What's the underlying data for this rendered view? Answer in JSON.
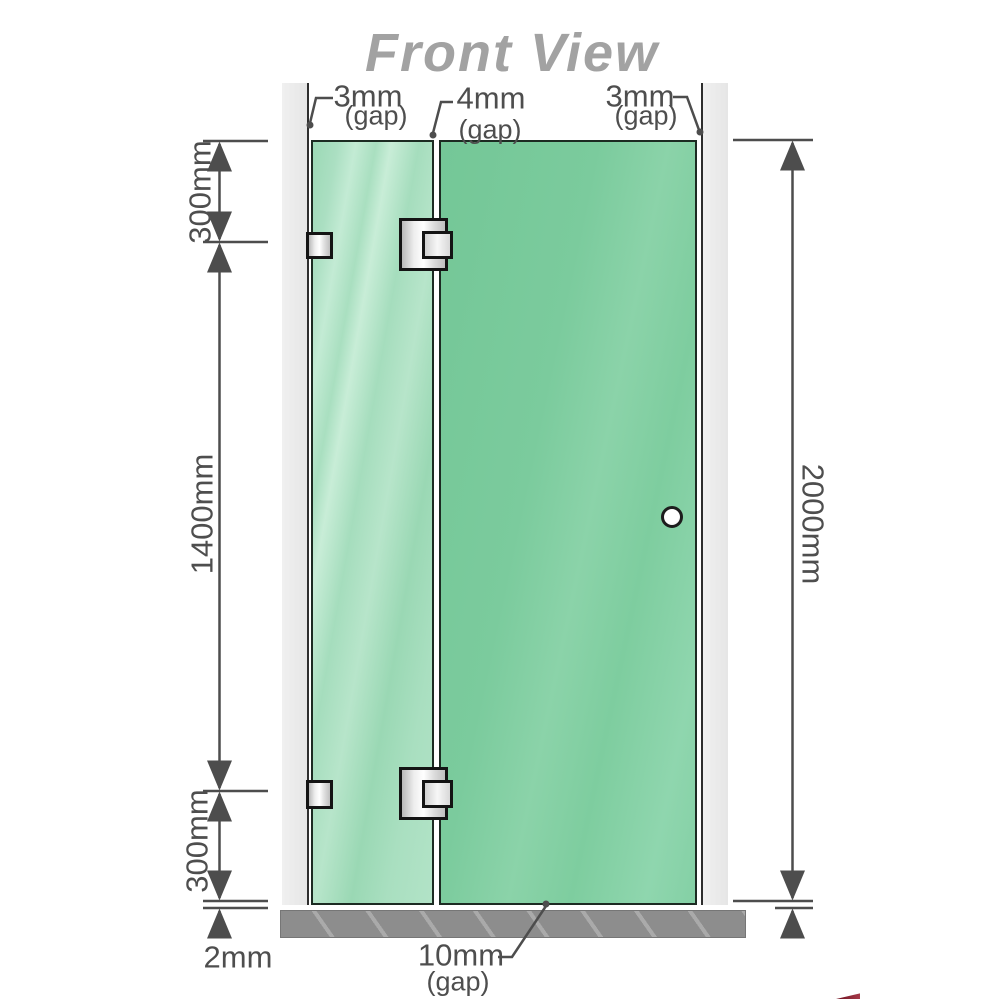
{
  "title": "Front View",
  "annotations": {
    "gap_top_left": {
      "value": "3mm",
      "note": "(gap)"
    },
    "gap_top_middle": {
      "value": "4mm",
      "note": "(gap)"
    },
    "gap_top_right": {
      "value": "3mm",
      "note": "(gap)"
    },
    "gap_bottom": {
      "value": "10mm",
      "note": "(gap)"
    },
    "floor_clearance": {
      "value": "2mm"
    }
  },
  "dimensions": {
    "left_top": "300mm",
    "left_middle": "1400mm",
    "left_bottom": "300mm",
    "right_total": "2000mm"
  },
  "colors": {
    "glass_fixed_panel": "#a9dfc0",
    "glass_door_panel": "#7ecd9f",
    "glass_outline": "#1c2b22",
    "wall": "#ebebeb",
    "floor": "#8d8d8d",
    "dimension_lines": "#4d4d4d",
    "title_text": "#a2a2a2",
    "hardware_metal": "#e8e8e8",
    "logo_fragment": "#7a1322"
  }
}
